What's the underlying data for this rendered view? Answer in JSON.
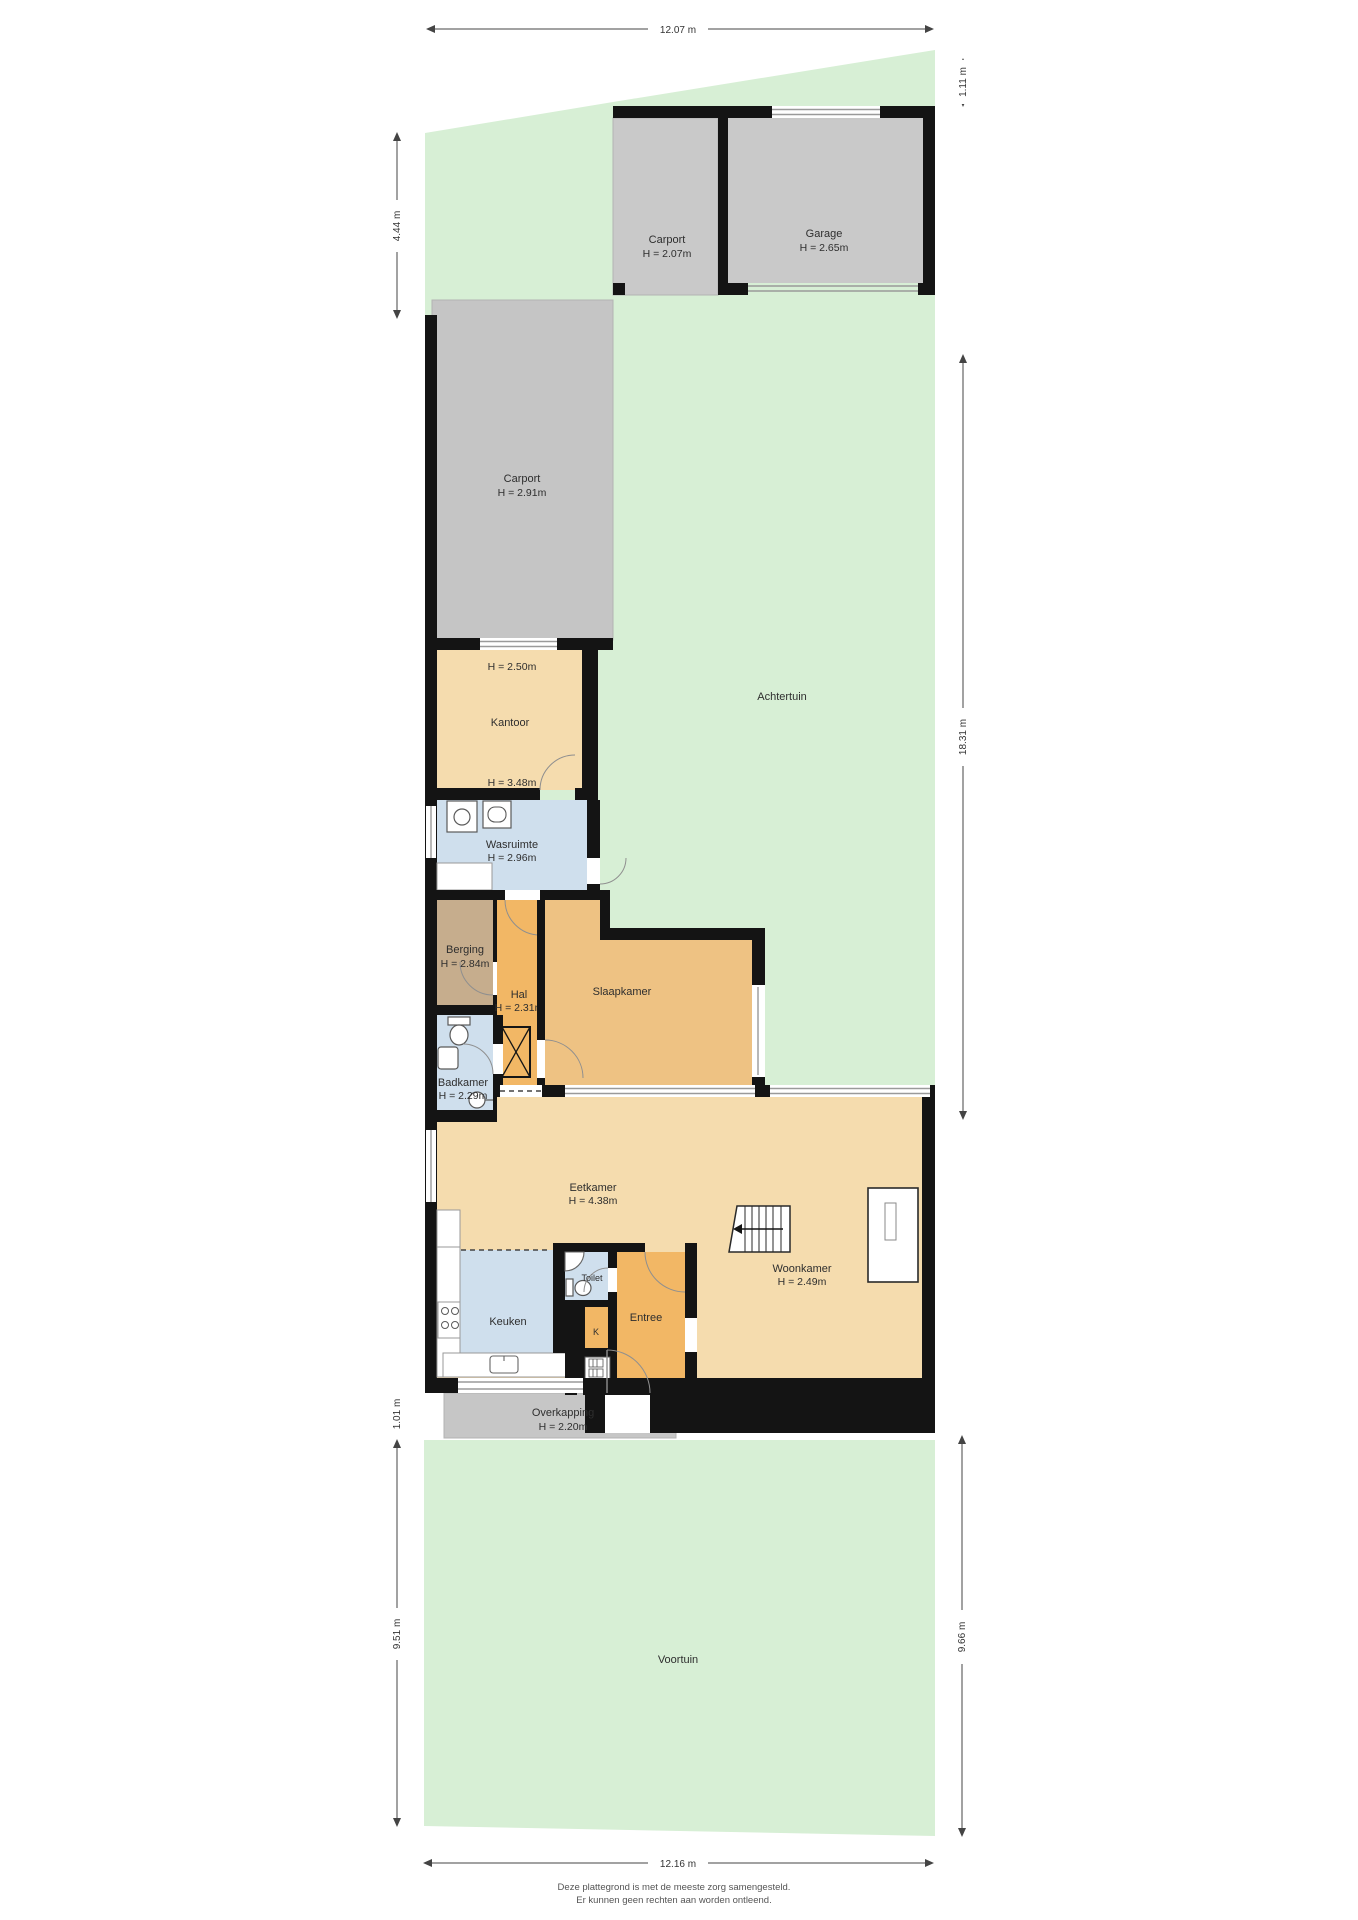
{
  "meta": {
    "footer_line1": "Deze plattegrond is met de meeste zorg samengesteld.",
    "footer_line2": "Er kunnen geen rechten aan worden ontleend."
  },
  "dimensions": {
    "top": "12.07 m",
    "top_right": "1.11 m",
    "upper_left": "4.44 m",
    "middle_right": "18.31 m",
    "overkapping_left": "1.01 m",
    "lower_left": "9.51 m",
    "lower_right": "9.66 m",
    "bottom": "12.16 m"
  },
  "gardens": {
    "achtertuin": "Achtertuin",
    "voortuin": "Voortuin"
  },
  "rooms": {
    "carport_top": {
      "label": "Carport",
      "height": "H = 2.07m"
    },
    "garage": {
      "label": "Garage",
      "height": "H = 2.65m"
    },
    "carport_long": {
      "label": "Carport",
      "height": "H = 2.91m"
    },
    "kantoor": {
      "label": "Kantoor",
      "height_front": "H = 2.50m",
      "height_back": "H = 3.48m"
    },
    "wasruimte": {
      "label": "Wasruimte",
      "height": "H = 2.96m"
    },
    "berging": {
      "label": "Berging",
      "height": "H = 2.84m"
    },
    "hal": {
      "label": "Hal",
      "height": "H = 2.31m"
    },
    "slaapkamer": {
      "label": "Slaapkamer"
    },
    "badkamer": {
      "label": "Badkamer",
      "height": "H = 2.29m"
    },
    "eetkamer": {
      "label": "Eetkamer",
      "height": "H = 4.38m"
    },
    "woonkamer": {
      "label": "Woonkamer",
      "height": "H = 2.49m"
    },
    "keuken": {
      "label": "Keuken"
    },
    "toilet": {
      "label": "Toilet"
    },
    "entree": {
      "label": "Entree"
    },
    "kast": {
      "label": "K"
    },
    "meterkast": {
      "label": "MK"
    },
    "overkapping": {
      "label": "Overkapping",
      "height": "H = 2.20m"
    }
  },
  "colors": {
    "garden_green": "#d7efd5",
    "structure_gray": "#c9c9c9",
    "carport_gray": "#c5c5c5",
    "overkapping_gray": "#c6c6c6",
    "room_tan": "#f5dcae",
    "room_orange": "#eec283",
    "room_deep_orange": "#f2b765",
    "room_blue": "#cfdfed",
    "room_brown": "#c6ad8d",
    "wall_black": "#141414"
  }
}
